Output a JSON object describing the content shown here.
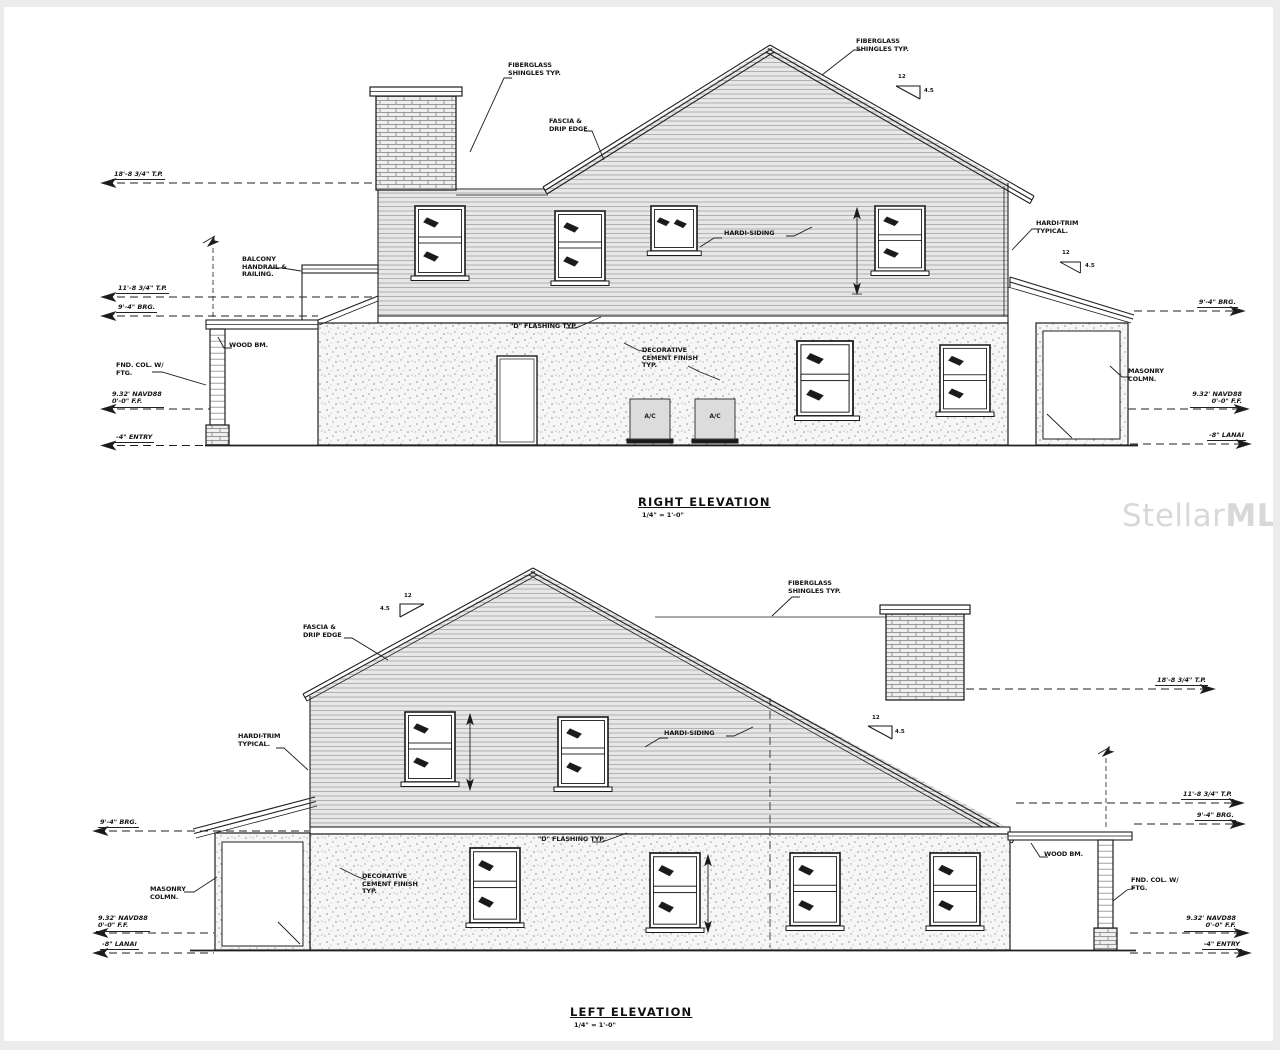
{
  "watermark": {
    "text1": "Stellar",
    "text2": "MLS"
  },
  "pitch": {
    "run": "12",
    "rise": "4.5"
  },
  "right": {
    "title": "RIGHT ELEVATION",
    "scale": "1/4\" = 1'-0\"",
    "shingles_left": "FIBERGLASS\nSHINGLES TYP.",
    "shingles_right": "FIBERGLASS\nSHINGLES TYP.",
    "fascia": "FASCIA &\nDRIP EDGE",
    "siding": "HARDI-SIDING",
    "trim": "HARDI-TRIM\nTYPICAL.",
    "balcony": "BALCONY\nHANDRAIL &\nRAILING.",
    "wood_beam": "WOOD BM.",
    "fnd_col": "FND. COL. W/\nFTG.",
    "flashing": "\"D\" FLASHING TYP.",
    "cement": "DECORATIVE\nCEMENT FINISH\nTYP.",
    "masonry": "MASONRY\nCOLMN.",
    "ac": "A/C",
    "tp18": "18'-8 3/4\" T.P.",
    "tp11": "11'-8 3/4\" T.P.",
    "brg": "9'-4\" BRG.",
    "ff": "9.32' NAVD88\n0'-0\" F.F.",
    "entry": "-4\" ENTRY",
    "lanai": "-8\" LANAI"
  },
  "left": {
    "title": "LEFT ELEVATION",
    "scale": "1/4\" = 1'-0\"",
    "shingles": "FIBERGLASS\nSHINGLES TYP.",
    "fascia": "FASCIA &\nDRIP EDGE",
    "siding": "HARDI-SIDING",
    "trim": "HARDI-TRIM\nTYPICAL.",
    "wood_beam": "WOOD BM.",
    "fnd_col": "FND. COL. W/\nFTG.",
    "flashing": "\"D\" FLASHING TYP.",
    "cement": "DECORATIVE\nCEMENT FINISH\nTYP.",
    "masonry": "MASONRY\nCOLMN.",
    "tp18": "18'-8 3/4\" T.P.",
    "tp11": "11'-8 3/4\" T.P.",
    "brg": "9'-4\" BRG.",
    "ff": "9.32' NAVD88\n0'-0\" F.F.",
    "entry": "-4\" ENTRY",
    "lanai": "-8\" LANAI"
  }
}
